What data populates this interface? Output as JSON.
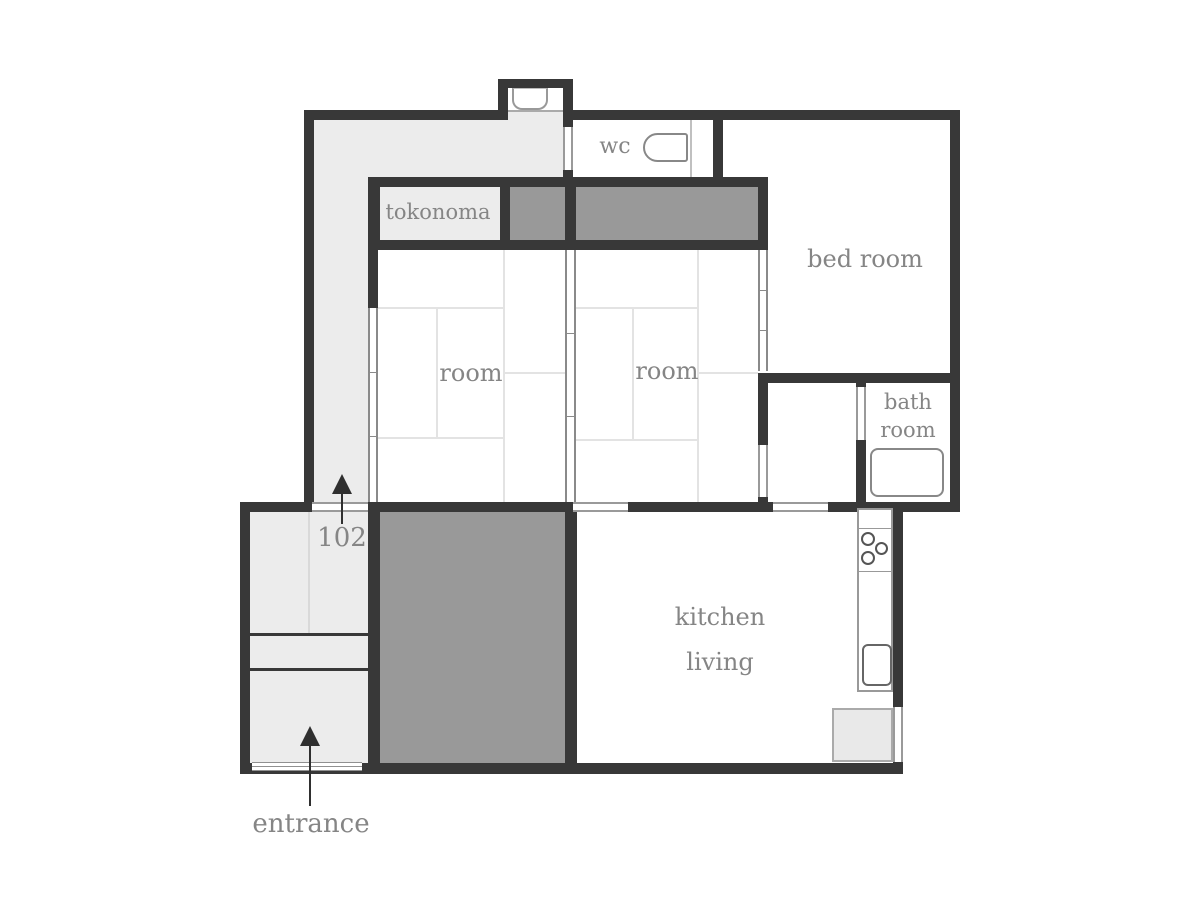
{
  "floorplan": {
    "unit_number": "102",
    "labels": {
      "tokonoma": "tokonoma",
      "wc": "wc",
      "bedroom": "bed room",
      "room_left": "room",
      "room_right": "room",
      "bathroom_line1": "bath",
      "bathroom_line2": "room",
      "kitchen_line1": "kitchen",
      "kitchen_line2": "living",
      "entrance": "entrance"
    },
    "icons": {
      "toilet": "toilet-icon",
      "washbasin": "washbasin-icon",
      "bathtub": "bathtub-icon",
      "stove": "stove-burners-icon",
      "kitchen_sink": "kitchen-sink-icon",
      "refrigerator": "refrigerator-space",
      "direction_arrows": "up-arrow-icon"
    },
    "colors": {
      "wall": "#383838",
      "hallway_fill": "#ececec",
      "closet_fill": "#999999",
      "tatami_line": "#e3e3e3",
      "label_text": "#858585",
      "background": "#ffffff"
    }
  }
}
